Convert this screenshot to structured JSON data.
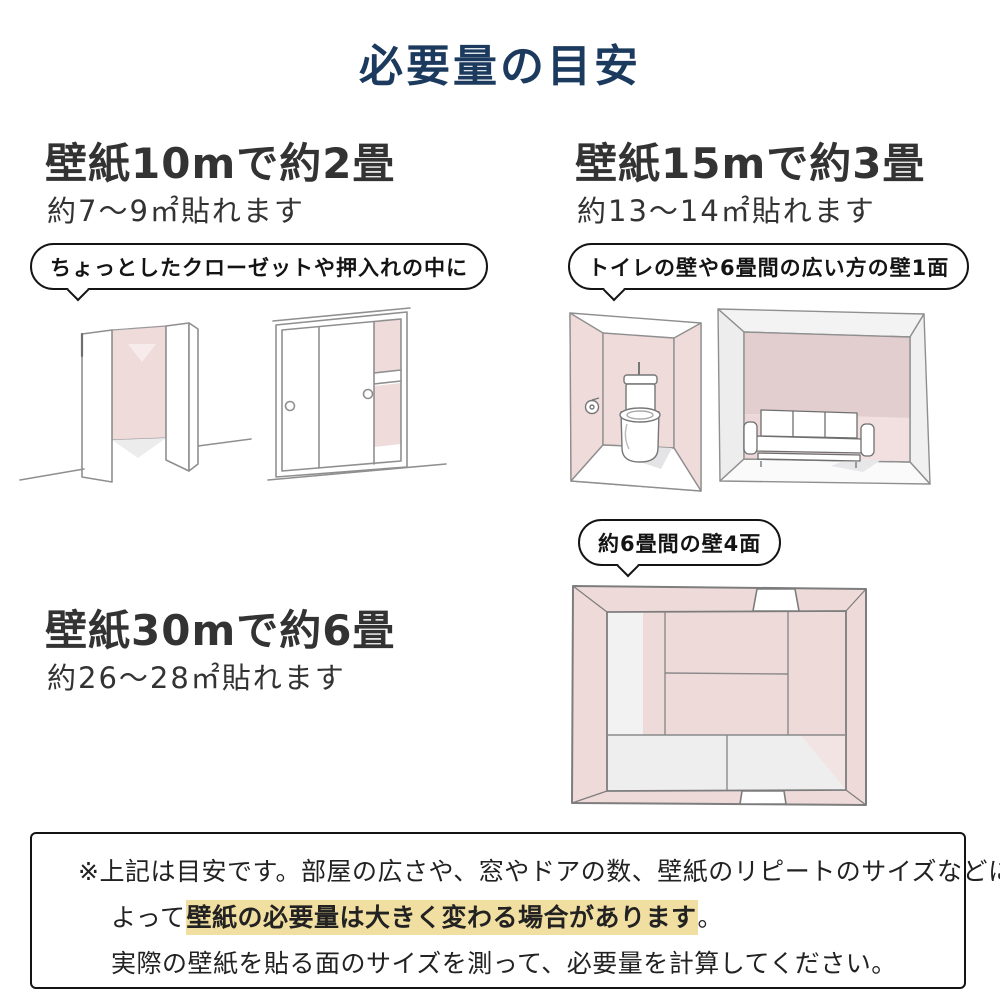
{
  "title": "必要量の目安",
  "sections": {
    "s10m": {
      "heading": "壁紙10mで約2畳",
      "subheading": "約7〜9㎡貼れます",
      "bubble": "ちょっとしたクローゼットや押入れの中に",
      "illustrations": [
        "hinged-door-closet",
        "sliding-door-closet"
      ]
    },
    "s15m": {
      "heading": "壁紙15mで約3畳",
      "subheading": "約13〜14㎡貼れます",
      "bubble": "トイレの壁や6畳間の広い方の壁1面",
      "illustrations": [
        "toilet-room",
        "six-mat-room-with-sofa"
      ]
    },
    "s30m": {
      "heading": "壁紙30mで約6畳",
      "subheading": "約26〜28㎡貼れます",
      "bubble": "約6畳間の壁4面",
      "illustrations": [
        "six-mat-room-top-view"
      ]
    }
  },
  "note": {
    "line1": "※上記は目安です。部屋の広さや、窓やドアの数、壁紙のリピートのサイズなどに",
    "line2_prefix": "よって",
    "line2_highlight": "壁紙の必要量は大きく変わる場合があります",
    "line2_suffix": "。",
    "line3": "実際の壁紙を貼る面のサイズを測って、必要量を計算してください。"
  },
  "colors": {
    "title_navy": "#1b3a5e",
    "heading_gray": "#333333",
    "bubble_border": "#141414",
    "wall_pink": "#f0dbdb",
    "wall_pink_dark": "#e3cecf",
    "floor_gray": "#ededee",
    "highlight_yellow": "#f1dfa2"
  }
}
